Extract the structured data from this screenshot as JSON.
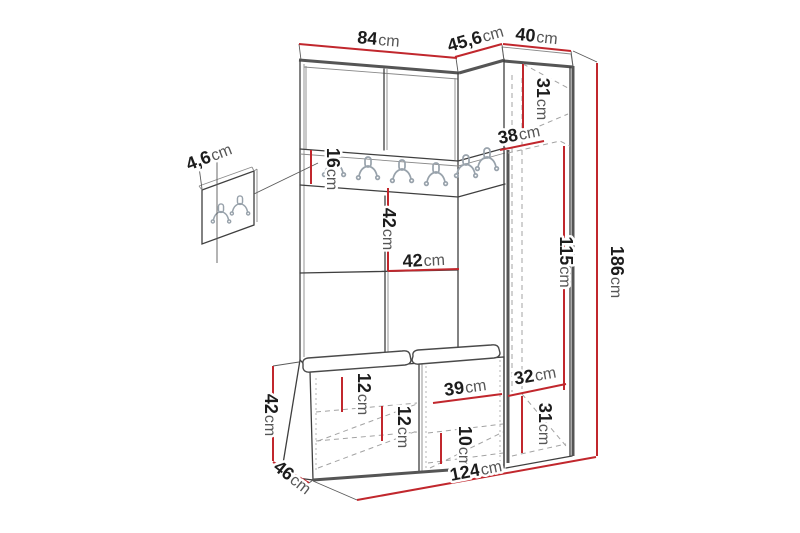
{
  "diagram": {
    "kind": "furniture-dimension-diagram",
    "subject": "hallway-wardrobe-with-coat-rack-and-bench",
    "measurement_unit": "cm",
    "colors": {
      "background": "#ffffff",
      "dimension_line": "#c1272d",
      "outline": "#3f3f3f",
      "hidden_edge": "#a3a3a3",
      "hook": "#98a2ab",
      "label_number": "#1c1c1c",
      "label_unit": "#565656"
    },
    "icons": {
      "coat_hook": "double-prong-coat-hook-icon"
    },
    "dims": {
      "top_width_left": {
        "value": "84",
        "unit": "cm"
      },
      "top_depth": {
        "value": "45,6",
        "unit": "cm"
      },
      "top_width_right": {
        "value": "40",
        "unit": "cm"
      },
      "panel_thickness": {
        "value": "4,6",
        "unit": "cm"
      },
      "rail_height": {
        "value": "16",
        "unit": "cm"
      },
      "cabinet_top_section_height": {
        "value": "31",
        "unit": "cm"
      },
      "cabinet_depth": {
        "value": "38",
        "unit": "cm"
      },
      "mid_section_height": {
        "value": "42",
        "unit": "cm"
      },
      "mid_section_width": {
        "value": "42",
        "unit": "cm"
      },
      "cabinet_inner_height": {
        "value": "115",
        "unit": "cm"
      },
      "total_height": {
        "value": "186",
        "unit": "cm"
      },
      "bench_right_depth": {
        "value": "32",
        "unit": "cm"
      },
      "cabinet_bottom_section_height": {
        "value": "31",
        "unit": "cm"
      },
      "bench_top_gap": {
        "value": "12",
        "unit": "cm"
      },
      "bench_shelf_gap_left": {
        "value": "12",
        "unit": "cm"
      },
      "bench_compartment_width": {
        "value": "39",
        "unit": "cm"
      },
      "bench_shelf_gap_right": {
        "value": "10",
        "unit": "cm"
      },
      "bench_height": {
        "value": "42",
        "unit": "cm"
      },
      "bench_depth": {
        "value": "46",
        "unit": "cm"
      },
      "total_width": {
        "value": "124",
        "unit": "cm"
      }
    }
  }
}
